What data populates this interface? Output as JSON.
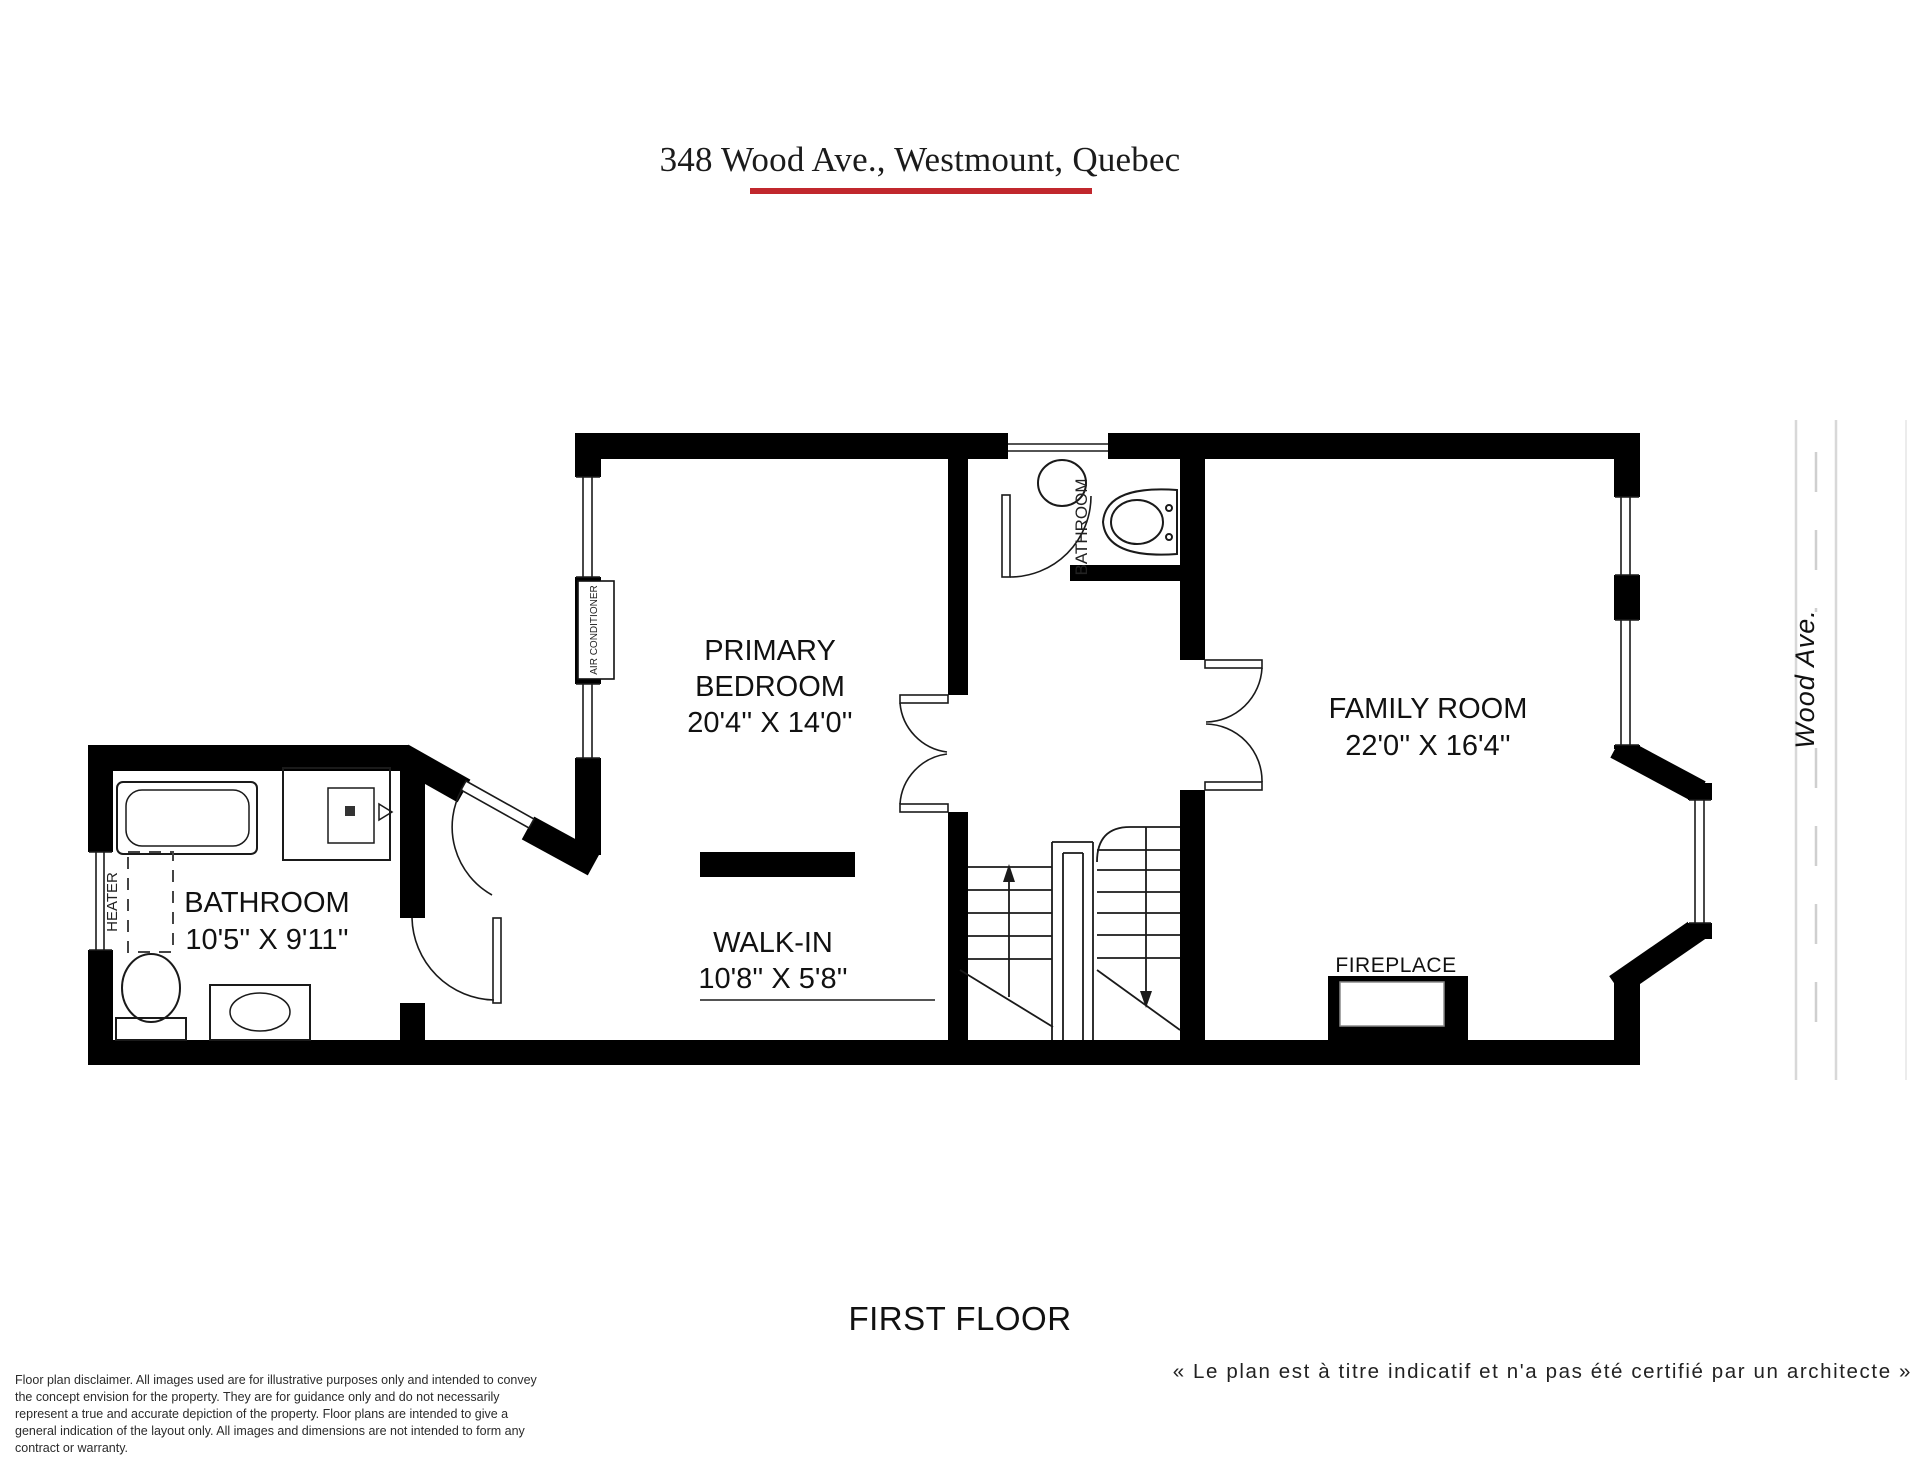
{
  "header": {
    "title": "348 Wood Ave., Westmount, Quebec",
    "accent_color": "#c1272d"
  },
  "plan": {
    "rooms": {
      "primary_bedroom": {
        "line1": "PRIMARY",
        "line2": "BEDROOM",
        "dims": "20'4'' X 14'0''"
      },
      "family_room": {
        "line1": "FAMILY ROOM",
        "dims": "22'0'' X 16'4''"
      },
      "bathroom": {
        "line1": "BATHROOM",
        "dims": "10'5'' X 9'11''"
      },
      "walk_in": {
        "line1": "WALK-IN",
        "dims": "10'8'' X 5'8''"
      },
      "upper_bathroom": {
        "label": "BATHROOM"
      }
    },
    "features": {
      "fireplace": "FIREPLACE",
      "heater": "HEATER",
      "air_conditioner": "AIR CONDITIONER"
    },
    "street": {
      "name": "Wood Ave."
    }
  },
  "footer": {
    "floor_label": "FIRST FLOOR",
    "french_note": "« Le plan est à titre indicatif et n'a pas été certifié par un architecte »",
    "disclaimer": "Floor plan disclaimer. All images used are for illustrative purposes only and intended to convey the concept envision for the property. They are for guidance only and do not necessarily represent a true and accurate depiction of the property. Floor plans are intended to give a general indication of the layout only. All images and dimensions are not intended to form any contract or warranty."
  }
}
